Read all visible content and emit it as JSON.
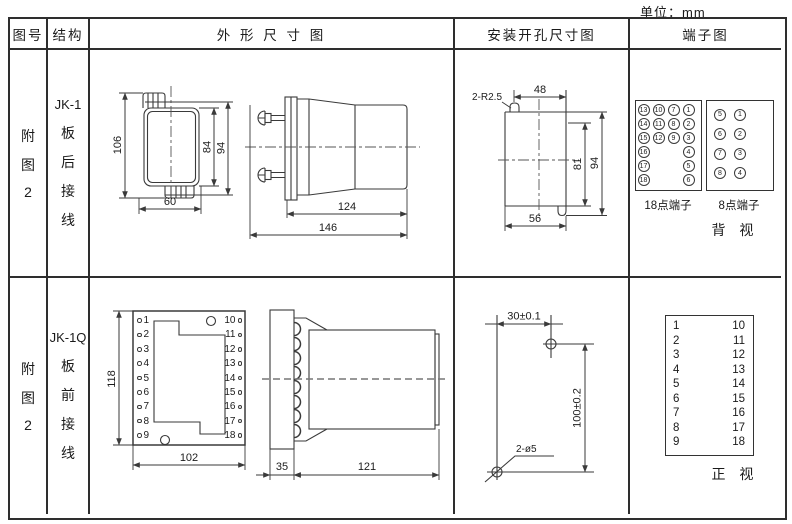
{
  "unit_label": "单位：mm",
  "header": {
    "figure": "图号",
    "structure": "结构",
    "outline": "外 形 尺 寸 图",
    "install": "安装开孔尺寸图",
    "terminal": "端子图"
  },
  "row1": {
    "figure_lines": [
      "附",
      "图",
      "2"
    ],
    "structure_model": "JK-1",
    "structure_lines": [
      "板",
      "后",
      "接",
      "线"
    ],
    "outline_dims": {
      "h106": "106",
      "h84": "84",
      "h94": "94",
      "w60": "60",
      "d124": "124",
      "d146": "146"
    },
    "install_dims": {
      "slot": "2-R2.5",
      "w48": "48",
      "h81": "81",
      "h94": "94",
      "w56": "56"
    },
    "terminal": {
      "grid18": [
        "13",
        "10",
        "7",
        "1",
        "14",
        "11",
        "8",
        "2",
        "15",
        "12",
        "9",
        "3",
        "16",
        "",
        "",
        "4",
        "17",
        "",
        "",
        "5",
        "18",
        "",
        "",
        "6"
      ],
      "grid8": [
        "5",
        "1",
        "6",
        "2",
        "7",
        "3",
        "8",
        "4"
      ],
      "label18": "18点端子",
      "label8": "8点端子",
      "view": "背 视"
    }
  },
  "row2": {
    "figure_lines": [
      "附",
      "图",
      "2"
    ],
    "structure_model": "JK-1Q",
    "structure_lines": [
      "板",
      "前",
      "接",
      "线"
    ],
    "outline_dims": {
      "h118": "118",
      "w102": "102",
      "w35": "35",
      "d121": "121"
    },
    "outline_terms": {
      "left": [
        "1",
        "2",
        "3",
        "4",
        "5",
        "6",
        "7",
        "8",
        "9"
      ],
      "right": [
        "10",
        "11",
        "12",
        "13",
        "14",
        "15",
        "16",
        "17",
        "18"
      ]
    },
    "install_dims": {
      "w30": "30±0.1",
      "h100": "100±0.2",
      "holes": "2-ø5"
    },
    "terminal": {
      "left": [
        "1",
        "2",
        "3",
        "4",
        "5",
        "6",
        "7",
        "8",
        "9"
      ],
      "right": [
        "10",
        "11",
        "12",
        "13",
        "14",
        "15",
        "16",
        "17",
        "18"
      ],
      "view": "正 视"
    }
  }
}
